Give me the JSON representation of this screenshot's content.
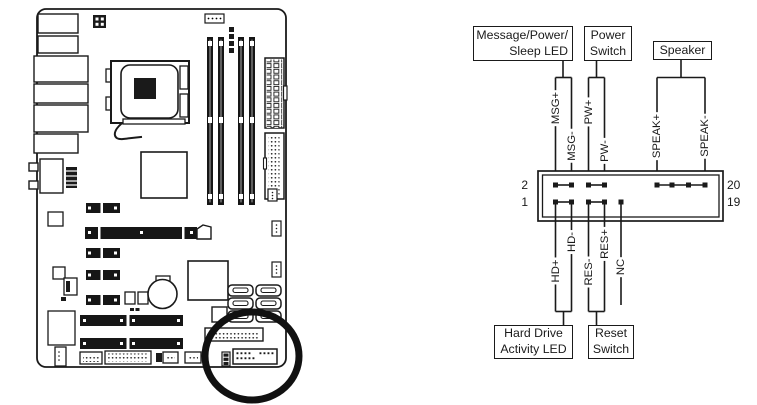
{
  "diagram_title": "front-panel-header-connection-diagram",
  "boxes": {
    "msg_led_line1": "Message/Power/",
    "msg_led_line2": "Sleep LED",
    "power_switch_line1": "Power",
    "power_switch_line2": "Switch",
    "speaker": "Speaker",
    "hdd_led_line1": "Hard Drive",
    "hdd_led_line2": "Activity LED",
    "reset_line1": "Reset",
    "reset_line2": "Switch"
  },
  "pin_numbers": {
    "top_left": "2",
    "bottom_left": "1",
    "top_right": "20",
    "bottom_right": "19"
  },
  "signals": {
    "msg_plus": "MSG+",
    "msg_minus": "MSG-",
    "pw_plus": "PW+",
    "pw_minus": "PW-",
    "speak_plus": "SPEAK+",
    "speak_minus": "SPEAK-",
    "hd_plus": "HD+",
    "hd_minus": "HD-",
    "res_minus": "RES-",
    "res_plus": "RES+",
    "nc": "NC"
  },
  "colors": {
    "line": "#1a1a1a",
    "background": "#ffffff",
    "slot_fill": "#161616"
  }
}
